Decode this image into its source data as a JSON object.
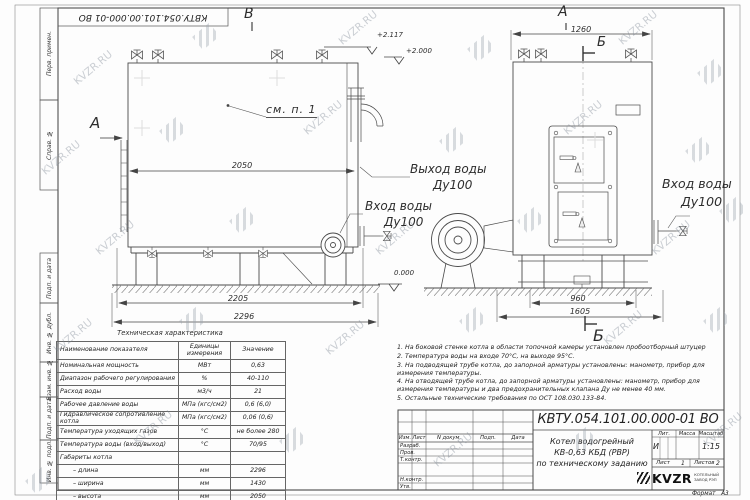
{
  "page": {
    "designation_top_rotated": "КВТУ.054.101.00.000-01 ВО",
    "watermark_text": "KVZR.RU",
    "format_label": "Формат",
    "format_value": "А3"
  },
  "frame_labels": [
    "Перв. примен.",
    "Справ. №",
    "Подп. и дата",
    "Инв. № дубл.",
    "Взам. инв. №",
    "Подп. и дата",
    "Инв. № подл."
  ],
  "drawing": {
    "view_marks": {
      "a_left": "А",
      "a_top": "А",
      "b_top": "Б",
      "b_bottom": "Б",
      "v_top": "В"
    },
    "callouts": {
      "see_item": "см. п. 1",
      "outlet_line1": "Выход воды",
      "outlet_line2": "Ду100",
      "inlet_line1": "Вход воды",
      "inlet_line2": "Ду100",
      "inlet_right_line1": "Вход воды",
      "inlet_right_line2": "Ду100"
    },
    "elevations": {
      "top": "+2.117",
      "mid": "+2.000",
      "zero": "0.000"
    },
    "dimensions": {
      "len_top": "2050",
      "len_mid": "2205",
      "len_full": "2296",
      "width_top": "1260",
      "width_base": "960",
      "width_full": "1605"
    }
  },
  "spec_table": {
    "title": "Техническая характеристика",
    "headers": [
      "Наименование показателя",
      "Единицы измерения",
      "Значение"
    ],
    "rows": [
      [
        "Номинальная мощность",
        "МВт",
        "0,63"
      ],
      [
        "Диапазон рабочего регулирования",
        "%",
        "40-110"
      ],
      [
        "Расход воды",
        "м3/ч",
        "21"
      ],
      [
        "Рабочее давление воды",
        "МПа (кгс/см2)",
        "0,6 (6,0)"
      ],
      [
        "Гидравлическое сопротивление котла",
        "МПа (кгс/см2)",
        "0,06 (0,6)"
      ],
      [
        "Температура уходящих газов",
        "°С",
        "не более 280"
      ],
      [
        "Температура воды (вход/выход)",
        "°С",
        "70/95"
      ],
      [
        "Габариты котла",
        "",
        ""
      ],
      [
        "– длина",
        "мм",
        "2296"
      ],
      [
        "– ширина",
        "мм",
        "1430"
      ],
      [
        "– высота",
        "мм",
        "2050"
      ]
    ]
  },
  "notes": [
    "1. На боковой стенке котла в области топочной камеры установлен пробоотборный штуцер",
    "2. Температура воды на входе 70°С, на выходе 95°С.",
    "3. На подводящей трубе котла, до запорной арматуры установлены: манометр, прибор для измерения температуры.",
    "4. На отводящей трубе котла, до запорной арматуры установлены: манометр, прибор для измерения температуры и два предохранительных клапана Ду не менее 40 мм.",
    "5. Остальные технические требования по ОСТ 108.030.133-84."
  ],
  "title_block": {
    "designation": "КВТУ.054.101.00.000-01 ВО",
    "header_cols": [
      "Изм.",
      "Лист",
      "N докум.",
      "Подп.",
      "Дата"
    ],
    "roles": [
      "Разраб.",
      "Пров.",
      "Т.контр.",
      "Н.контр.",
      "Утв."
    ],
    "name_line1": "Котел водогрейный",
    "name_line2": "КВ-0,63 КБД (РВР)",
    "name_line3": "по техническому заданию",
    "lit_label": "Лит.",
    "lit_value": "И",
    "mass_label": "Масса",
    "scale_label": "Масштаб",
    "scale_value": "1:15",
    "sheet_label": "Лист",
    "sheet_value": "1",
    "sheets_label": "Листов",
    "sheets_value": "2",
    "logo_text": "KVZR",
    "logo_sub1": "КОТЕЛЬНЫЙ",
    "logo_sub2": "ЗАВОД РЭП"
  }
}
